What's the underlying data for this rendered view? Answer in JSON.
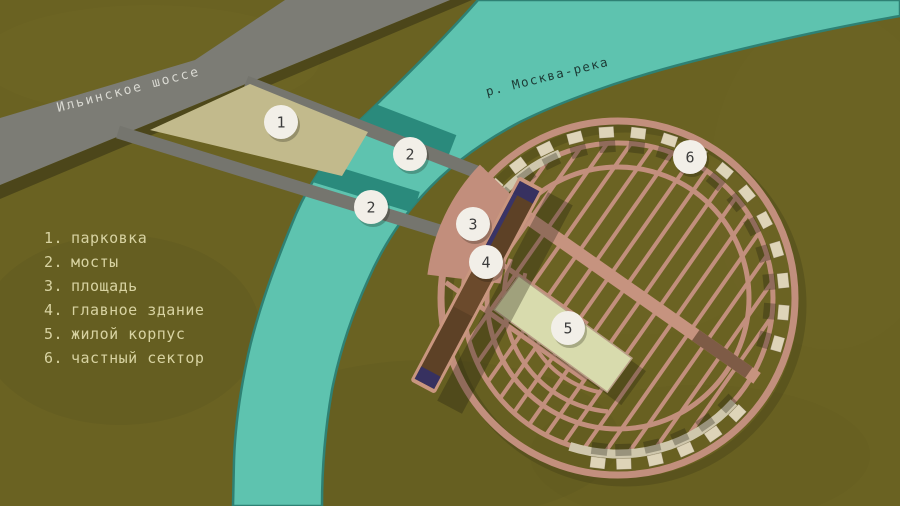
{
  "map": {
    "road_label": "Ильинское шоссе",
    "river_label": "р. Москва-река",
    "legend": [
      {
        "number": "1.",
        "label": "парковка"
      },
      {
        "number": "2.",
        "label": "мосты"
      },
      {
        "number": "3.",
        "label": "площадь"
      },
      {
        "number": "4.",
        "label": "главное здание"
      },
      {
        "number": "5.",
        "label": "жилой корпус"
      },
      {
        "number": "6.",
        "label": "частный сектор"
      }
    ],
    "markers": [
      {
        "label": "1",
        "x": 281,
        "y": 122
      },
      {
        "label": "2",
        "x": 410,
        "y": 154
      },
      {
        "label": "2",
        "x": 371,
        "y": 207
      },
      {
        "label": "3",
        "x": 473,
        "y": 224
      },
      {
        "label": "4",
        "x": 486,
        "y": 262
      },
      {
        "label": "5",
        "x": 568,
        "y": 328
      },
      {
        "label": "6",
        "x": 690,
        "y": 157
      }
    ],
    "house_angles": [
      222,
      233,
      244,
      255,
      266,
      277,
      288,
      299,
      310,
      321,
      332,
      343,
      354,
      5,
      16,
      44,
      55,
      66,
      77,
      88,
      97
    ],
    "colors": {
      "background": "#6a6222",
      "river": "#5ec3af",
      "river_edge": "#2e8174",
      "river_shadow": "#2a8a7c",
      "road_gray": "#7c7c75",
      "path_pink": "#c28f7d",
      "plaza_pink": "#c28e7c",
      "parking_beige": "#c2ba8c",
      "building_dark_brown": "#5d4126",
      "building_navy": "#373160",
      "residential_light": "#d8dbad",
      "house_beige": "#ded4b8",
      "marker_bg": "#f2efe8",
      "legend_text": "#d8d3a2"
    }
  }
}
